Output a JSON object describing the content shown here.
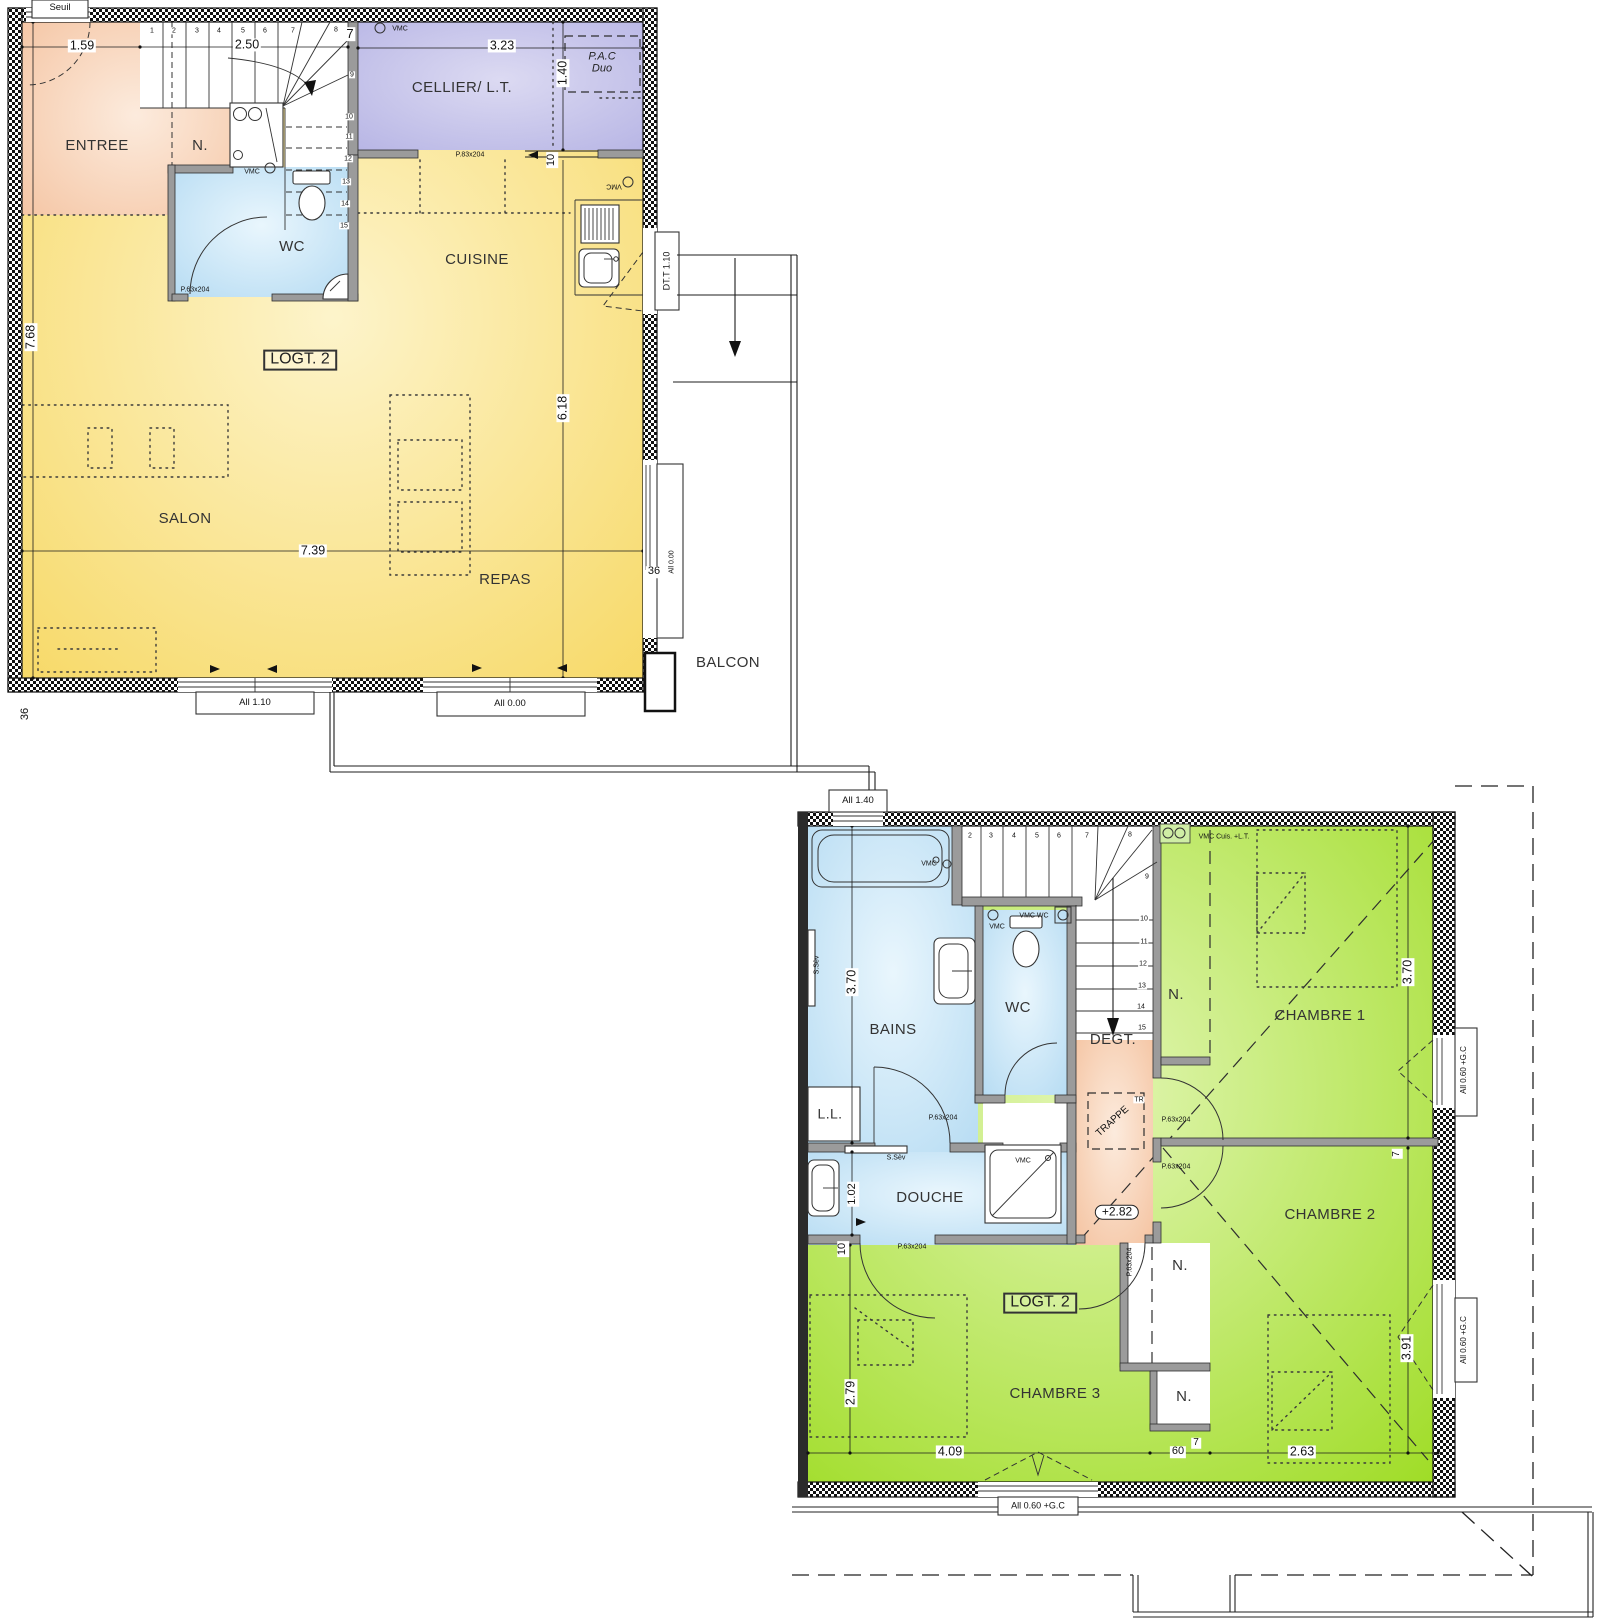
{
  "unit_label": "LOGT. 2",
  "colors": {
    "living_yellow": "#f7da69",
    "bedroom_green": "#a5de2c",
    "wet_blue": "#badcf2",
    "hall_salmon": "#f6c5a4",
    "cellar_lavender": "#b9b7e6",
    "wall_gray": "#9b9b9b"
  },
  "rooms_floor1": [
    "ENTREE",
    "N.",
    "WC",
    "CELLIER/ L.T.",
    "CUISINE",
    "SALON",
    "REPAS",
    "BALCON"
  ],
  "rooms_floor2": [
    "BAINS",
    "WC",
    "DEGT.",
    "DOUCHE",
    "L.L.",
    "CHAMBRE 1",
    "CHAMBRE 2",
    "CHAMBRE 3"
  ],
  "floor1": {
    "annotations": [
      {
        "t": "Seuil",
        "x": 60,
        "y": 8,
        "c": "win",
        "n": "seuil-label"
      },
      {
        "t": "1.59",
        "x": 82,
        "y": 46,
        "c": "dim",
        "n": "dim-1-59"
      },
      {
        "t": "2.50",
        "x": 247,
        "y": 45,
        "c": "dim",
        "n": "dim-2-50"
      },
      {
        "t": "7",
        "x": 350,
        "y": 34,
        "c": "dim",
        "s": 13,
        "n": "dim-7-wall"
      },
      {
        "t": "3.23",
        "x": 502,
        "y": 46,
        "c": "dim",
        "n": "dim-3-23"
      },
      {
        "t": "VMC",
        "x": 400,
        "y": 29,
        "c": "tiny",
        "n": "vmc-cellier"
      },
      {
        "t": "P.A.C Duo",
        "x": 602,
        "y": 63,
        "c": "pac",
        "n": "pac-duo-label"
      },
      {
        "t": "1.40",
        "x": 563,
        "y": 73,
        "r": -90,
        "c": "dim",
        "n": "dim-1-40"
      },
      {
        "t": "CELLIER/ L.T.",
        "x": 462,
        "y": 88,
        "c": "room",
        "n": "room-label-cellier"
      },
      {
        "t": "ENTREE",
        "x": 97,
        "y": 146,
        "c": "room",
        "n": "room-label-entree"
      },
      {
        "t": "N.",
        "x": 200,
        "y": 146,
        "c": "room",
        "n": "closet-label-entree"
      },
      {
        "t": "P.83x204",
        "x": 470,
        "y": 155,
        "c": "tiny",
        "n": "door-label-cellier"
      },
      {
        "t": "10",
        "x": 552,
        "y": 160,
        "r": -90,
        "c": "dim",
        "s": 11,
        "n": "dim-10-wall"
      },
      {
        "t": "VMC",
        "x": 252,
        "y": 172,
        "c": "tiny",
        "n": "vmc-wc1"
      },
      {
        "t": "VMC",
        "x": 614,
        "y": 186,
        "r": 180,
        "c": "tiny",
        "n": "vmc-cuisine"
      },
      {
        "t": "WC",
        "x": 292,
        "y": 247,
        "c": "room",
        "n": "room-label-wc1"
      },
      {
        "t": "CUISINE",
        "x": 477,
        "y": 260,
        "c": "room",
        "n": "room-label-cuisine"
      },
      {
        "t": "DT.T 1.10",
        "x": 667,
        "y": 271,
        "r": -90,
        "c": "win",
        "s": 9,
        "n": "door-label-dtt"
      },
      {
        "t": "P.63x204",
        "x": 195,
        "y": 290,
        "c": "tiny",
        "n": "door-label-wc1"
      },
      {
        "t": "LOGT. 2",
        "x": 300,
        "y": 360,
        "c": "box",
        "n": "unit-label-floor1"
      },
      {
        "t": "7.68",
        "x": 31,
        "y": 337,
        "r": -90,
        "c": "dim",
        "n": "dim-7-68"
      },
      {
        "t": "6.18",
        "x": 563,
        "y": 408,
        "r": -90,
        "c": "dim",
        "n": "dim-6-18"
      },
      {
        "t": "SALON",
        "x": 185,
        "y": 519,
        "c": "room",
        "n": "room-label-salon"
      },
      {
        "t": "7.39",
        "x": 313,
        "y": 551,
        "c": "dim",
        "n": "dim-7-39"
      },
      {
        "t": "REPAS",
        "x": 505,
        "y": 580,
        "c": "room",
        "n": "room-label-repas"
      },
      {
        "t": "36",
        "x": 654,
        "y": 572,
        "c": "dim",
        "s": 11,
        "n": "dim-36-right"
      },
      {
        "t": "All 0.00",
        "x": 672,
        "y": 562,
        "r": -90,
        "c": "tiny",
        "n": "sill-label-right"
      },
      {
        "t": "All 1.10",
        "x": 255,
        "y": 703,
        "c": "win",
        "n": "window-label-all110"
      },
      {
        "t": "All 0.00",
        "x": 510,
        "y": 704,
        "c": "win",
        "n": "window-label-all000"
      },
      {
        "t": "36",
        "x": 26,
        "y": 714,
        "r": -90,
        "c": "dim",
        "s": 11,
        "n": "dim-36-left"
      },
      {
        "t": "BALCON",
        "x": 728,
        "y": 663,
        "c": "room",
        "n": "room-label-balcon"
      },
      {
        "t": "1",
        "x": 152,
        "y": 31,
        "c": "stair"
      },
      {
        "t": "2",
        "x": 174,
        "y": 31,
        "c": "stair"
      },
      {
        "t": "3",
        "x": 197,
        "y": 31,
        "c": "stair"
      },
      {
        "t": "4",
        "x": 219,
        "y": 31,
        "c": "stair"
      },
      {
        "t": "5",
        "x": 243,
        "y": 31,
        "c": "stair"
      },
      {
        "t": "6",
        "x": 265,
        "y": 31,
        "c": "stair"
      },
      {
        "t": "7",
        "x": 293,
        "y": 31,
        "c": "stair"
      },
      {
        "t": "8",
        "x": 336,
        "y": 30,
        "c": "stair"
      },
      {
        "t": "9",
        "x": 352,
        "y": 75,
        "c": "stair"
      },
      {
        "t": "10",
        "x": 349,
        "y": 117,
        "c": "stair"
      },
      {
        "t": "11",
        "x": 349,
        "y": 137,
        "c": "stair"
      },
      {
        "t": "12",
        "x": 348,
        "y": 159,
        "c": "stair"
      },
      {
        "t": "13",
        "x": 346,
        "y": 182,
        "c": "stair"
      },
      {
        "t": "14",
        "x": 345,
        "y": 204,
        "c": "stair"
      },
      {
        "t": "15",
        "x": 344,
        "y": 226,
        "c": "stair"
      }
    ]
  },
  "floor2": {
    "annotations": [
      {
        "t": "All 1.40",
        "x": 858,
        "y": 801,
        "c": "win",
        "n": "window-label-all140"
      },
      {
        "t": "VMC",
        "x": 929,
        "y": 864,
        "c": "tiny",
        "n": "vmc-bains"
      },
      {
        "t": "2",
        "x": 970,
        "y": 836,
        "c": "stair"
      },
      {
        "t": "3",
        "x": 991,
        "y": 836,
        "c": "stair"
      },
      {
        "t": "4",
        "x": 1014,
        "y": 836,
        "c": "stair"
      },
      {
        "t": "5",
        "x": 1037,
        "y": 836,
        "c": "stair"
      },
      {
        "t": "6",
        "x": 1059,
        "y": 836,
        "c": "stair"
      },
      {
        "t": "7",
        "x": 1087,
        "y": 836,
        "c": "stair"
      },
      {
        "t": "8",
        "x": 1130,
        "y": 835,
        "c": "stair"
      },
      {
        "t": "9",
        "x": 1147,
        "y": 877,
        "c": "stair"
      },
      {
        "t": "10",
        "x": 1144,
        "y": 919,
        "c": "stair"
      },
      {
        "t": "11",
        "x": 1144,
        "y": 942,
        "c": "stair"
      },
      {
        "t": "12",
        "x": 1143,
        "y": 964,
        "c": "stair"
      },
      {
        "t": "13",
        "x": 1142,
        "y": 986,
        "c": "stair"
      },
      {
        "t": "14",
        "x": 1141,
        "y": 1007,
        "c": "stair"
      },
      {
        "t": "15",
        "x": 1142,
        "y": 1028,
        "c": "stair"
      },
      {
        "t": "VMC",
        "x": 997,
        "y": 927,
        "c": "tiny",
        "n": "vmc-wc2"
      },
      {
        "t": "VMC WC",
        "x": 1034,
        "y": 916,
        "c": "tiny",
        "n": "vmc-wc2-box"
      },
      {
        "t": "VMC Cuis. +L.T.",
        "x": 1224,
        "y": 837,
        "c": "tiny",
        "n": "vmc-cuisine-lt"
      },
      {
        "t": "3.70",
        "x": 852,
        "y": 982,
        "r": -90,
        "c": "dim",
        "n": "dim-3-70-bains"
      },
      {
        "t": "3.70",
        "x": 1408,
        "y": 972,
        "r": -90,
        "c": "dim",
        "n": "dim-3-70-ch1"
      },
      {
        "t": "N.",
        "x": 1176,
        "y": 995,
        "c": "room",
        "n": "closet-label-ch1"
      },
      {
        "t": "CHAMBRE 1",
        "x": 1320,
        "y": 1016,
        "c": "room",
        "n": "room-label-chambre1"
      },
      {
        "t": "BAINS",
        "x": 893,
        "y": 1030,
        "c": "room",
        "n": "room-label-bains"
      },
      {
        "t": "WC",
        "x": 1018,
        "y": 1008,
        "c": "room",
        "n": "room-label-wc2"
      },
      {
        "t": "DEGT.",
        "x": 1113,
        "y": 1040,
        "c": "room",
        "n": "room-label-degt"
      },
      {
        "t": "L.L.",
        "x": 830,
        "y": 1114,
        "c": "room",
        "s": 14,
        "n": "label-lave-linge"
      },
      {
        "t": "TRAPPE",
        "x": 1113,
        "y": 1122,
        "r": -42,
        "c": "win",
        "s": 10,
        "n": "label-trappe"
      },
      {
        "t": "TR",
        "x": 1139,
        "y": 1100,
        "c": "stair",
        "n": "label-tr"
      },
      {
        "t": "P.63x204",
        "x": 943,
        "y": 1118,
        "c": "tiny",
        "n": "door-label-bains"
      },
      {
        "t": "P.63x204",
        "x": 1176,
        "y": 1120,
        "c": "tiny",
        "n": "door-label-ch1"
      },
      {
        "t": "P.63x204",
        "x": 1176,
        "y": 1167,
        "c": "tiny",
        "n": "door-label-ch2"
      },
      {
        "t": "S.Sèv",
        "x": 817,
        "y": 965,
        "r": -90,
        "c": "tiny",
        "n": "radiator-label-bains"
      },
      {
        "t": "S.Sèv",
        "x": 896,
        "y": 1158,
        "c": "tiny",
        "n": "radiator-label-douche"
      },
      {
        "t": "1.02",
        "x": 853,
        "y": 1194,
        "r": -90,
        "c": "dim",
        "s": 11,
        "n": "dim-1-02"
      },
      {
        "t": "DOUCHE",
        "x": 930,
        "y": 1198,
        "c": "room",
        "n": "room-label-douche"
      },
      {
        "t": "VMC",
        "x": 1023,
        "y": 1161,
        "c": "tiny",
        "n": "vmc-douche"
      },
      {
        "t": "+2.82",
        "x": 1117,
        "y": 1212,
        "c": "lvl",
        "n": "level-marker"
      },
      {
        "t": "10",
        "x": 843,
        "y": 1249,
        "r": -90,
        "c": "dim",
        "s": 11,
        "n": "dim-10-douche"
      },
      {
        "t": "P.63x204",
        "x": 912,
        "y": 1247,
        "c": "tiny",
        "n": "door-label-douche"
      },
      {
        "t": "P.63x204",
        "x": 1130,
        "y": 1262,
        "r": -90,
        "c": "tiny",
        "n": "door-label-ch3"
      },
      {
        "t": "N.",
        "x": 1180,
        "y": 1266,
        "c": "room",
        "n": "closet-label-ch2"
      },
      {
        "t": "CHAMBRE 2",
        "x": 1330,
        "y": 1215,
        "c": "room",
        "n": "room-label-chambre2"
      },
      {
        "t": "7",
        "x": 1397,
        "y": 1154,
        "r": -90,
        "c": "dim",
        "s": 10,
        "n": "dim-7-ch12"
      },
      {
        "t": "LOGT. 2",
        "x": 1040,
        "y": 1303,
        "c": "box",
        "n": "unit-label-floor2"
      },
      {
        "t": "N.",
        "x": 1184,
        "y": 1397,
        "c": "room",
        "n": "closet-label-ch3"
      },
      {
        "t": "CHAMBRE 3",
        "x": 1055,
        "y": 1394,
        "c": "room",
        "n": "room-label-chambre3"
      },
      {
        "t": "2.79",
        "x": 851,
        "y": 1393,
        "r": -90,
        "c": "dim",
        "n": "dim-2-79"
      },
      {
        "t": "3.91",
        "x": 1407,
        "y": 1348,
        "r": -90,
        "c": "dim",
        "n": "dim-3-91"
      },
      {
        "t": "4.09",
        "x": 950,
        "y": 1452,
        "c": "dim",
        "n": "dim-4-09"
      },
      {
        "t": "60",
        "x": 1178,
        "y": 1452,
        "c": "dim",
        "s": 11,
        "n": "dim-60"
      },
      {
        "t": "7",
        "x": 1196,
        "y": 1443,
        "c": "dim",
        "s": 10,
        "n": "dim-7-ch3"
      },
      {
        "t": "2.63",
        "x": 1302,
        "y": 1452,
        "c": "dim",
        "n": "dim-2-63"
      },
      {
        "t": "All 0.60 +G.C",
        "x": 1038,
        "y": 1506,
        "c": "win",
        "s": 9,
        "n": "window-label-ch3"
      },
      {
        "t": "All 0.60 +G.C",
        "x": 1464,
        "y": 1070,
        "r": -90,
        "c": "win",
        "s": 8,
        "n": "window-label-ch1"
      },
      {
        "t": "All 0.60 +G.C",
        "x": 1464,
        "y": 1340,
        "r": -90,
        "c": "win",
        "s": 8,
        "n": "window-label-ch2"
      }
    ]
  }
}
